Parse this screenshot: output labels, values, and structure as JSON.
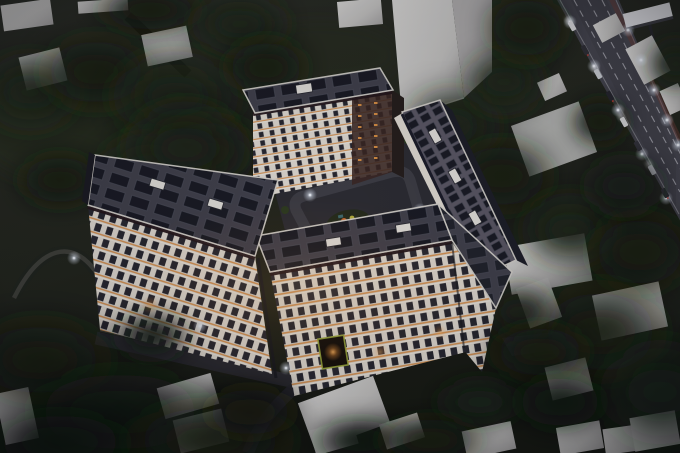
{
  "meta": {
    "title": "Residential complex — aerial dusk rendering",
    "description": "Aerial dusk 3D rendering of a large mid-rise residential apartment complex shaped around an inner courtyard. White facades with dark window bands glow warm orange on every floor. Flat roofs carry arrays of dark solar panels. The courtyard has a loop road, a small playground island and parked cars. The complex is surrounded by dark trees, plain white massing houses, curved footpaths, and a brightly lit multi-lane highway with car traffic and street lights running diagonally across the upper right corner.",
    "time_of_day": "dusk",
    "view": "aerial three-quarter"
  },
  "palette": {
    "bgTop": "#282b22",
    "bgBot": "#171a12",
    "grass": "#272d1f",
    "treeDark": "#131a0e",
    "treeMid": "#1c2515",
    "treeLight": "#2c3a1e",
    "pad": "#c6c8c4",
    "roofDark": "#41404a",
    "roofMauve": "#5b5763",
    "panel": "#181a22",
    "parapet": "#d8d5cd",
    "fascia": "#221418",
    "facade": "#e2ddd3",
    "windowDark": "#26262e",
    "glowOrange": "#d4863c",
    "glowWarm": "#ffb761",
    "brick": "#3a2520",
    "asphalt": "#2a2a2f",
    "roadHighway": "#45454d",
    "laneMark": "#cdcdd3",
    "redLane": "#6e3c34",
    "lightCool": "#eef2f8",
    "entranceGreen": "#9aa83a"
  },
  "scene": {
    "complex": {
      "label": "apartment complex",
      "wings": [
        {
          "name": "left wing",
          "floors": 9
        },
        {
          "name": "top tower",
          "floors": 10
        },
        {
          "name": "right wing",
          "floors": 9
        },
        {
          "name": "bottom wing",
          "floors": 8
        }
      ],
      "roof_features": [
        "solar panels",
        "roof access boxes",
        "white parapets"
      ],
      "courtyard_features": [
        "loop road",
        "playground island",
        "parked cars",
        "landscaping",
        "path lights"
      ],
      "entrance": "arched gateway with green-lit frame, bottom facade"
    },
    "highway": {
      "lanes": 4,
      "features": [
        "street lights",
        "car traffic",
        "billboard",
        "lane markings"
      ]
    },
    "surroundings": [
      "white massing houses",
      "dense dark trees",
      "curved footpaths",
      "access roads",
      "crosswalk"
    ]
  }
}
